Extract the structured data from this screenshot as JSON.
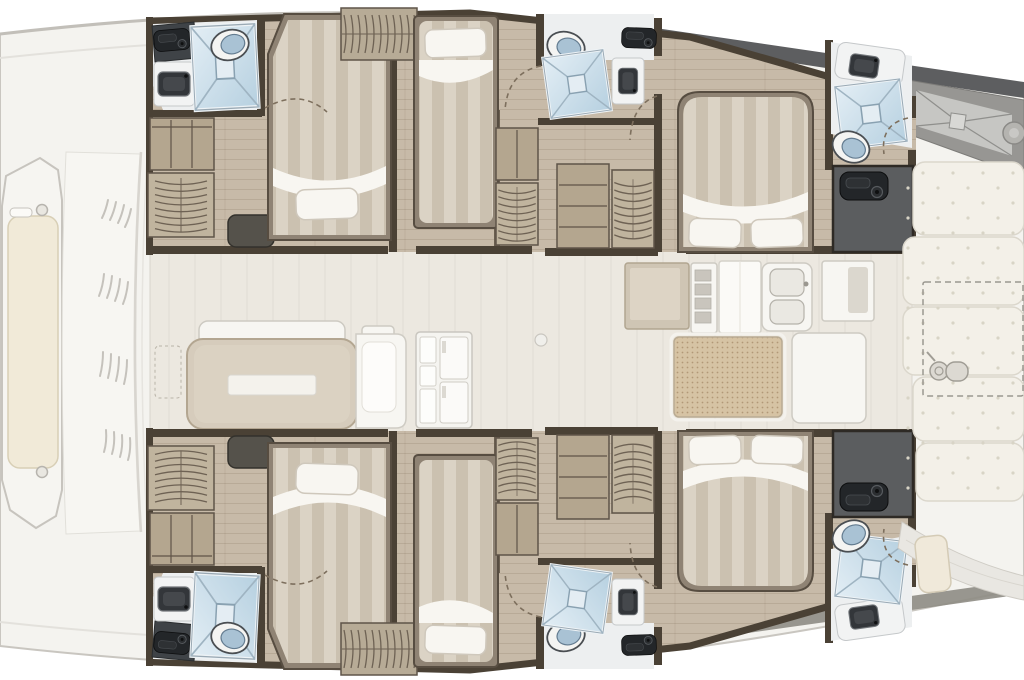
{
  "meta": {
    "description": "Top-down interior floor plan of a sailing catamaran: two symmetric hulls each with a forward double cabin, middle single cabin, three bathrooms with shower, toilet and sink, aft island-bed cabin and stern locker; central salon with dining table, settee and fridge cabinet; aft galley with stove grate and double sink; foredeck bench; aft cockpit bench cushions with winch and dashed davit outline."
  },
  "palette": {
    "deck": "#f4f3ef",
    "deck_line": "#c9c6c0",
    "floor_wood": "#c7baa8",
    "floor_center": "#ece8e0",
    "wall": "#4a4135",
    "furniture_wood": "#b4a68f",
    "furniture_wood_dark": "#8f8374",
    "bed_stripe_a": "#dbd3c5",
    "bed_stripe_b": "#cbc1b0",
    "linen": "#f8f6f1",
    "shower_blue_light": "#e3eef5",
    "shower_blue": "#b6d0e0",
    "shower_line": "#9fb4c2",
    "fixture_dark": "#33363a",
    "counter_dark": "#3f4347",
    "locker_gray": "#5b5d5f",
    "latch_black": "#232629",
    "cushion": "#f3f0e8",
    "cushion_dot": "#d8d4c6",
    "table_beige": "#d6ccbc",
    "grate": "#d6c3a4",
    "grate_dot": "#b29877",
    "hull_band": "#5d5e60",
    "hull_band_tan": "#a5947a",
    "toilet_lid": "#a9c2d4",
    "white_goods": "#f7f6f2",
    "arc_dash": "#7d6f5d"
  },
  "vessel": {
    "view": "plan",
    "bow": {
      "features": [
        "foredeck-bench",
        "bench-cushion",
        "deck-hatch-lines",
        "coachroof-edge"
      ]
    },
    "port_hull": {
      "position": "top",
      "rooms": [
        {
          "name": "forward-bathroom",
          "fixtures": [
            "vanity-counter",
            "latch-box",
            "sink",
            "shower",
            "toilet"
          ]
        },
        {
          "name": "forward-double-cabin",
          "furniture": [
            "double-bed",
            "pillow",
            "shelf-unit",
            "hanging-wardrobe",
            "ottoman"
          ]
        },
        {
          "name": "middle-single-cabin",
          "furniture": [
            "single-bed",
            "pillow",
            "overhead-wardrobe",
            "cubby-shelves",
            "hanging-locker"
          ]
        },
        {
          "name": "middle-bathroom",
          "fixtures": [
            "toilet",
            "shower",
            "sink",
            "latch-box"
          ]
        },
        {
          "name": "aft-storage",
          "furniture": [
            "four-shelf-unit",
            "hanging-wardrobe"
          ]
        },
        {
          "name": "aft-double-cabin",
          "furniture": [
            "island-double-bed",
            "pillow",
            "pillow"
          ]
        },
        {
          "name": "aft-bathroom",
          "fixtures": [
            "sink",
            "shower",
            "toilet"
          ]
        },
        {
          "name": "stern-locker",
          "fixtures": [
            "latch-box"
          ]
        }
      ]
    },
    "starboard_hull": {
      "position": "bottom",
      "mirrors": "port_hull"
    },
    "salon": {
      "furniture": [
        "bench-backrest",
        "dining-table",
        "white-tray",
        "settee",
        "fridge-cabinet",
        "floor-mat-outline",
        "deck-fitting"
      ]
    },
    "galley": {
      "fixtures": [
        "beige-counter",
        "drawer-island",
        "tall-counter",
        "double-sink",
        "side-cabinet",
        "stove-grate",
        "stove-side-counter"
      ]
    },
    "aft_cockpit": {
      "bench_cushions": 5,
      "features": [
        "dashed-davit-outline",
        "winch",
        "transom-stowage-triangle",
        "transom-steps",
        "transom-seat-cushion"
      ]
    },
    "counts": {
      "double_cabins": 4,
      "single_cabins": 2,
      "bathrooms": 6,
      "showers": 6,
      "toilets": 6,
      "sinks_bath": 6
    }
  }
}
